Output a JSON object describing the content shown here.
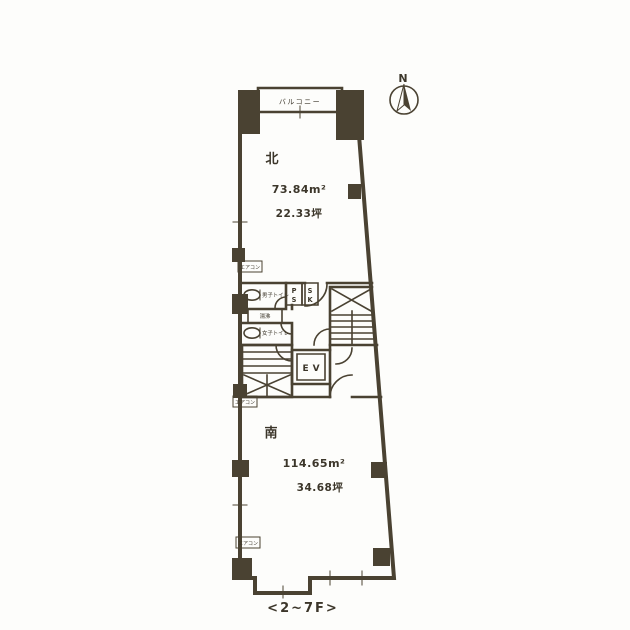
{
  "colors": {
    "ink": "#4a4232",
    "paper": "#fdfdfb"
  },
  "compass": {
    "label": "N"
  },
  "balcony": {
    "label": "バルコニー"
  },
  "rooms": {
    "north": {
      "name": "北",
      "area_m2": "73.84m²",
      "area_tsubo": "22.33坪"
    },
    "south": {
      "name": "南",
      "area_m2": "114.65m²",
      "area_tsubo": "34.68坪"
    }
  },
  "core": {
    "mens_toilet": "男子トイレ",
    "womens_toilet": "女子トイレ",
    "water_boiler": "湯沸",
    "ps_top": "P",
    "ps_bottom": "S",
    "sk_top": "S",
    "sk_bottom": "K",
    "elevator": "EV"
  },
  "aircon_label": "エアコン",
  "caption": "<2~7F>"
}
